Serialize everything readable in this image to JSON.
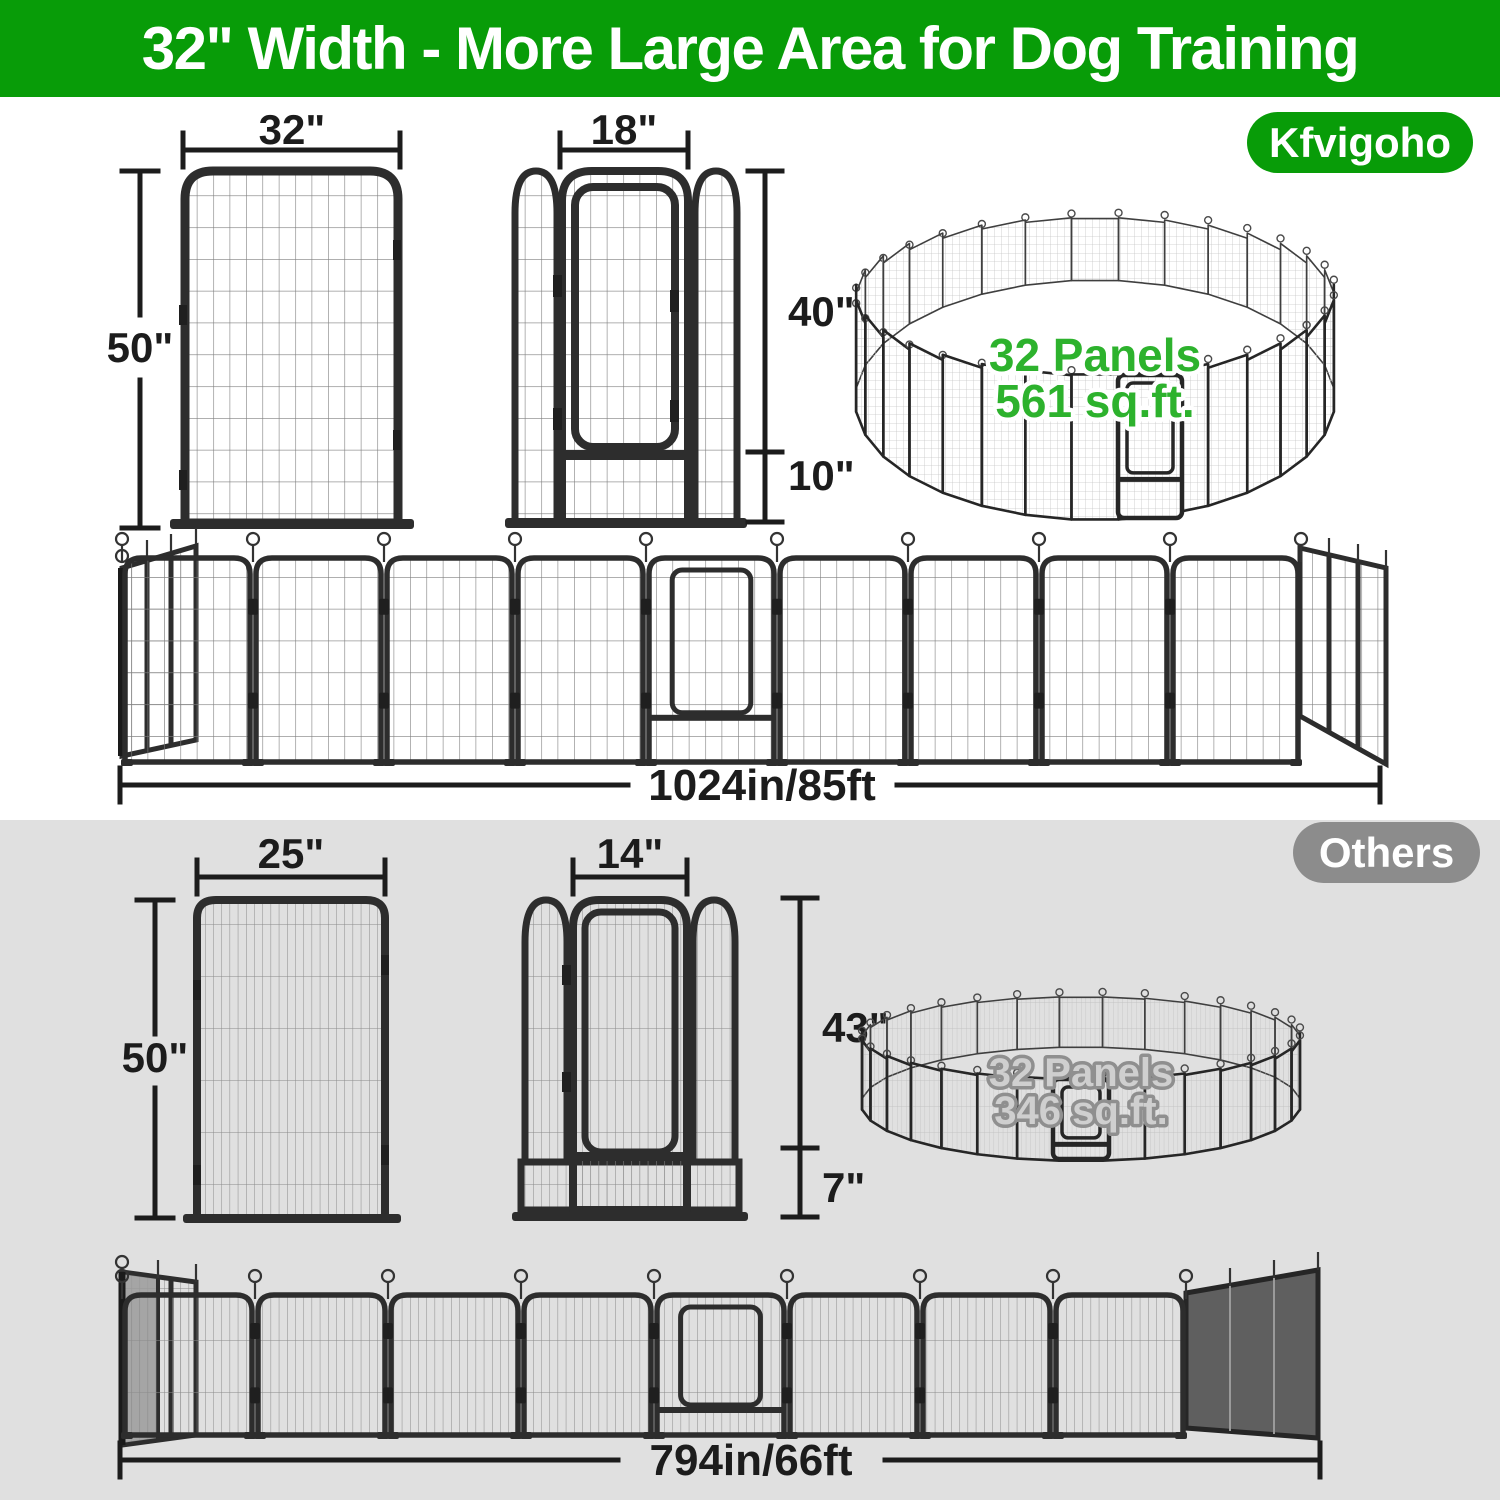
{
  "colors": {
    "brand_green": "#089C08",
    "ring_green": "#2DB22D",
    "others_gray": "#8C8C8C",
    "ring_gray_fill": "#CFCFCF",
    "ring_gray_outline": "#8F8F8F",
    "section_gray": "#E0E0E0",
    "ink": "#1C1C1C",
    "frame": "#2D2D2D"
  },
  "banner": {
    "title": "32\" Width - More Large Area for Dog Training"
  },
  "kfvigoho": {
    "brand_badge": "Kfvigoho",
    "panel": {
      "width": "32\"",
      "height": "50\""
    },
    "door_panel": {
      "width": "18\"",
      "door_height": "40\"",
      "bottom_height": "10\""
    },
    "ring": {
      "panels": "32 Panels",
      "area": "561 sq.ft."
    },
    "row": {
      "length": "1024in/85ft"
    }
  },
  "others": {
    "badge": "Others",
    "panel": {
      "width": "25\"",
      "height": "50\""
    },
    "door_panel": {
      "width": "14\"",
      "door_height": "43\"",
      "bottom_height": "7\""
    },
    "ring": {
      "panels": "32 Panels",
      "area": "346 sq.ft."
    },
    "row": {
      "length": "794in/66ft"
    }
  }
}
